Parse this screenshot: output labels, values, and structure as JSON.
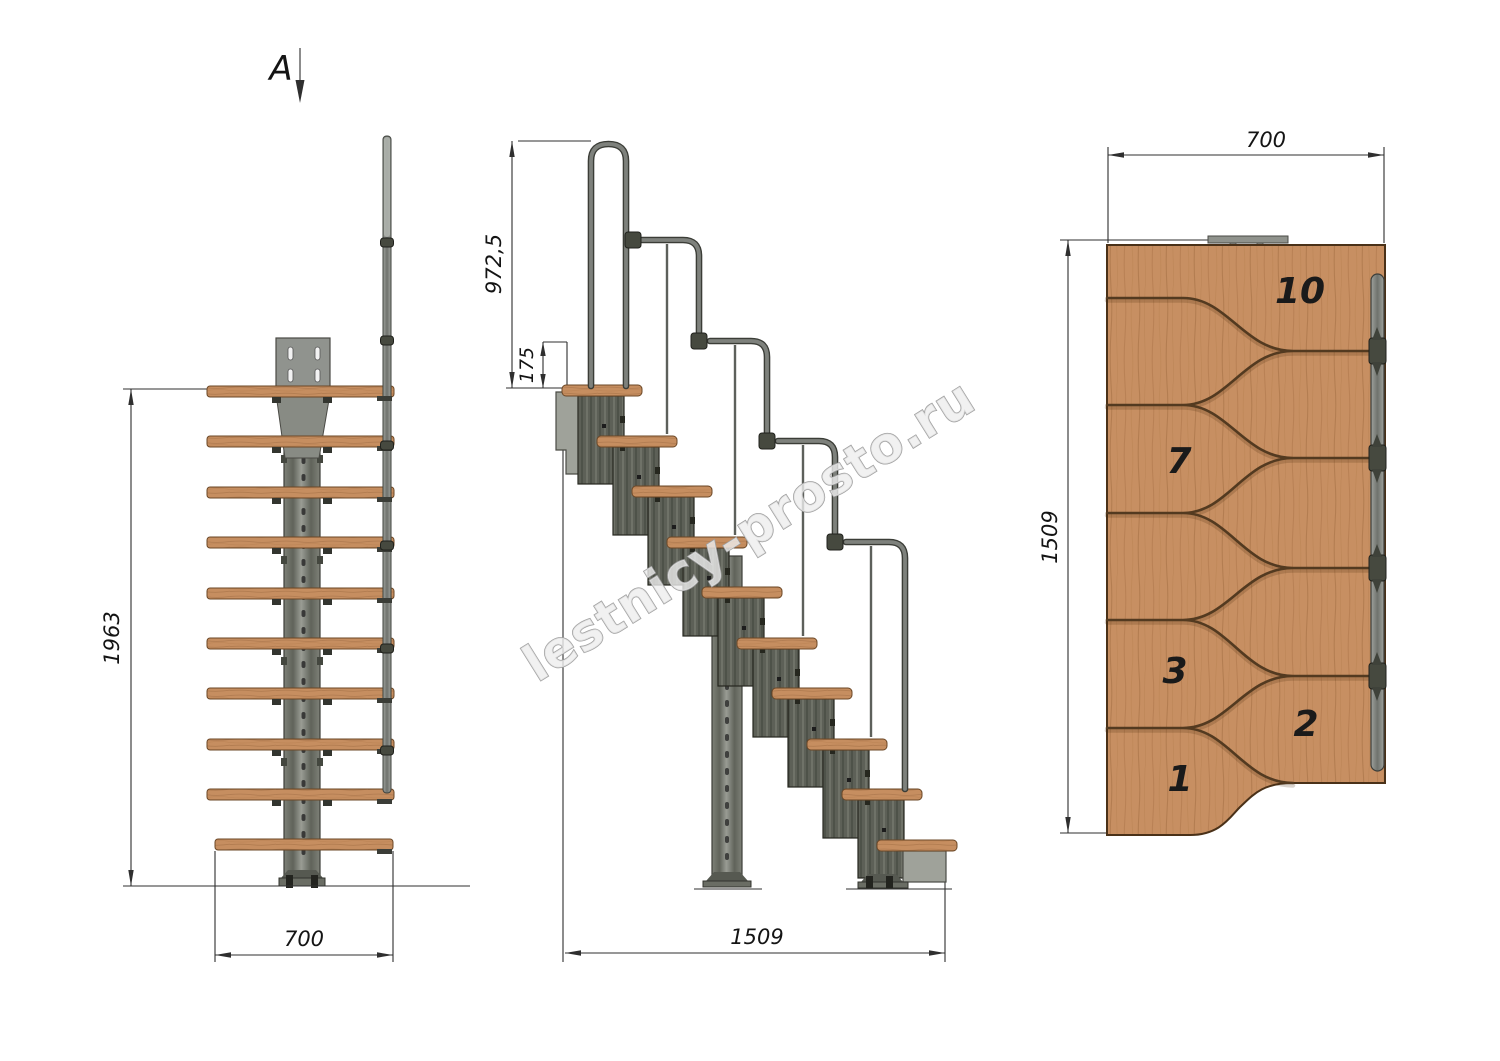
{
  "watermark": "lestnicy-prosto.ru",
  "views": {
    "front": {
      "name": "front view with section mark",
      "section_label": "A",
      "dim_height": "1963",
      "dim_width": "700"
    },
    "side": {
      "name": "side elevation",
      "dim_rail_height": "972,5",
      "dim_riser": "175",
      "dim_length": "1509"
    },
    "top": {
      "name": "plan view",
      "dim_width": "700",
      "dim_length": "1509",
      "step_labels": [
        "10",
        "7",
        "3",
        "2",
        "1"
      ]
    }
  },
  "colors": {
    "wood": "#c68e60",
    "wood_grain": "#a5714a",
    "steel_dark": "#5a5d54",
    "steel_light": "#9fa29a",
    "rail_gray": "#7e817c",
    "outline": "#26271f",
    "dim_line": "#2f2f2f",
    "text": "#141414",
    "watermark_fill": "#ededed",
    "background": "#ffffff"
  }
}
